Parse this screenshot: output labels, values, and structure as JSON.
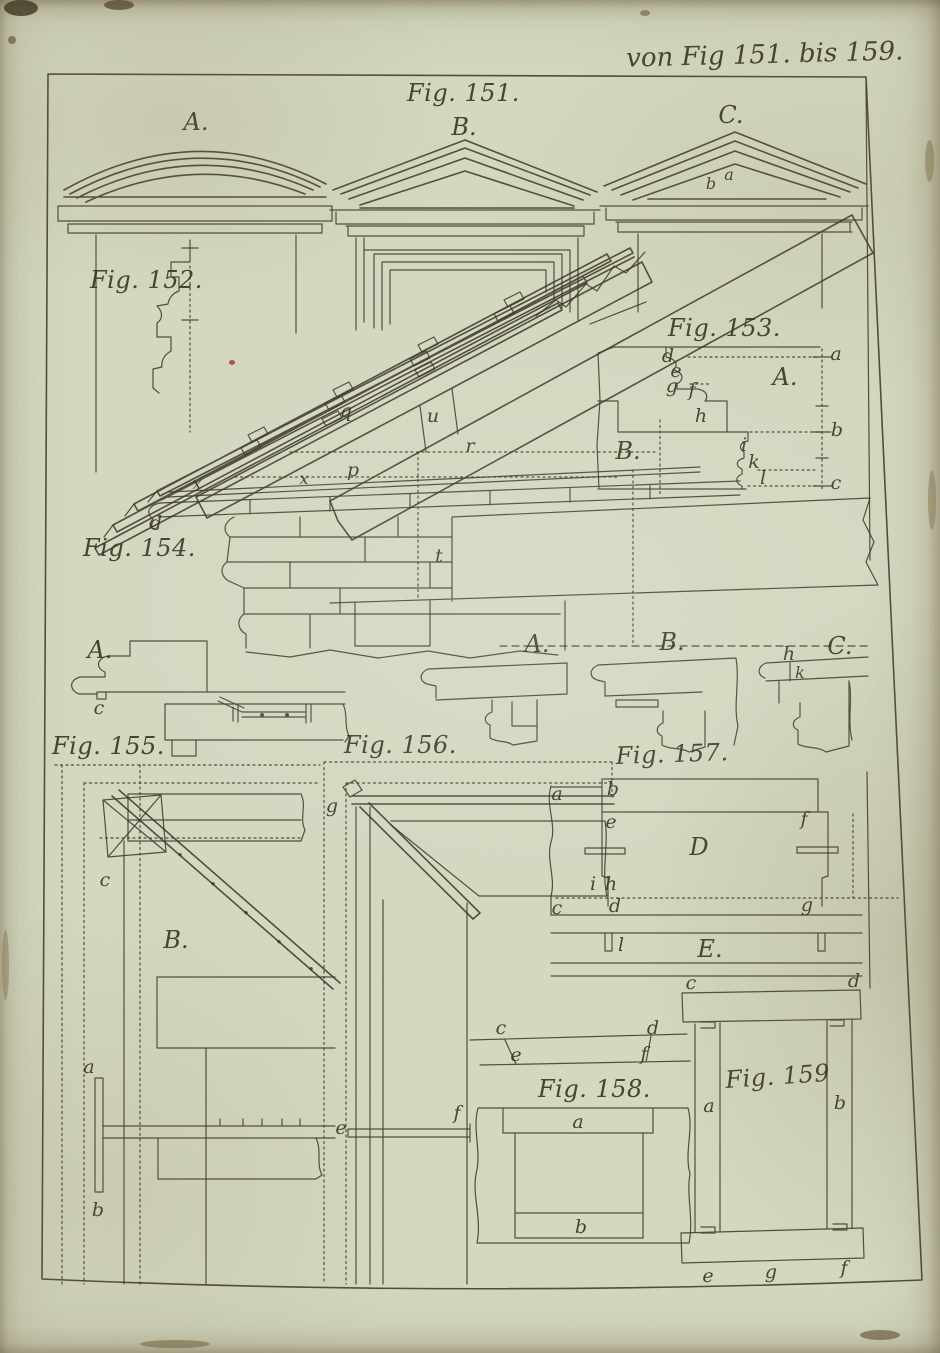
{
  "plate": {
    "caption": "von Fig 151. bis 159."
  },
  "colors": {
    "ink": "#3c3827",
    "paper": "#d5d9c2",
    "edge_brown": "#5e4d2c"
  },
  "fig151": {
    "title": "Fig. 151.",
    "A": "A.",
    "B": "B.",
    "C": "C.",
    "b": "b",
    "a": "a"
  },
  "fig152": {
    "title": "Fig. 152."
  },
  "fig153": {
    "title": "Fig. 153.",
    "A": "A.",
    "B": "B.",
    "d": "d",
    "e": "e",
    "g": "g",
    "f": "f",
    "h": "h",
    "i": "i",
    "k": "k",
    "l": "l",
    "a": "a",
    "b": "b",
    "c": "c"
  },
  "fig154": {
    "title": "Fig. 154.",
    "q": "q",
    "u": "u",
    "r": "r",
    "p": "p",
    "t": "t",
    "d": "d",
    "x1": "x",
    "x2": "x"
  },
  "fig155": {
    "title": "Fig. 155.",
    "A": "A.",
    "B": "B.",
    "c_section": "c",
    "c_bracket": "c",
    "a": "a",
    "b": "b"
  },
  "fig156": {
    "title": "Fig. 156.",
    "g": "g",
    "e": "e",
    "f": "f"
  },
  "fig157": {
    "title": "Fig. 157.",
    "A": "A.",
    "B": "B.",
    "C": "C.",
    "h_top": "h",
    "k_top": "k",
    "a": "a",
    "b": "b",
    "e": "e",
    "f": "f",
    "D": "D",
    "i": "i",
    "h": "h",
    "c": "c",
    "d": "d",
    "g": "g",
    "l": "l",
    "E": "E."
  },
  "fig158": {
    "title": "Fig. 158.",
    "c": "c",
    "d": "d",
    "e": "e",
    "f": "f",
    "a": "a",
    "b": "b"
  },
  "fig159": {
    "title": "Fig. 159",
    "c": "c",
    "d": "d",
    "a": "a",
    "b": "b",
    "e": "e",
    "g": "g",
    "f": "f"
  }
}
